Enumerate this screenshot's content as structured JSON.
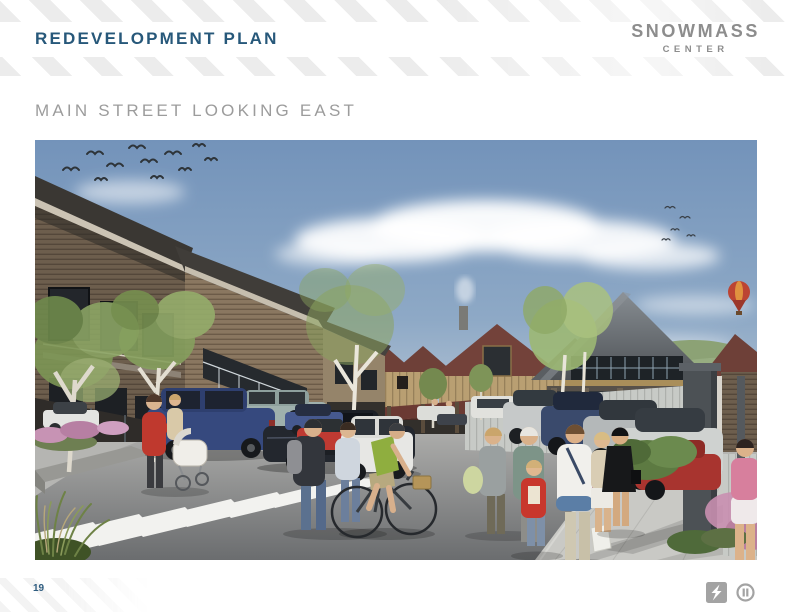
{
  "header": {
    "title": "REDEVELOPMENT PLAN"
  },
  "brand": {
    "line1": "SNOWMASS",
    "line2": "CENTER"
  },
  "main": {
    "subtitle": "MAIN STREET LOOKING EAST"
  },
  "footer": {
    "page_number": "19"
  },
  "palette": {
    "accent_blue": "#27587a",
    "logo_gray": "#8d8d8d",
    "subtitle_gray": "#9c9c9c",
    "stripe_gray": "#ececec",
    "page_number_blue": "#2f5d80",
    "sky_blue": "#7897bc",
    "hill_green": "#8ca275",
    "roof_maroon": "#6e4038",
    "roof_gray": "#5f6468",
    "wood_tan": "#b99f72",
    "street_gray": "#8f9092",
    "crosswalk_white": "#f2f2ef",
    "car_blue": "#36497e",
    "car_red": "#bf3a32",
    "flower_pink": "#c795b2",
    "tree_green": "#8aa35e"
  }
}
